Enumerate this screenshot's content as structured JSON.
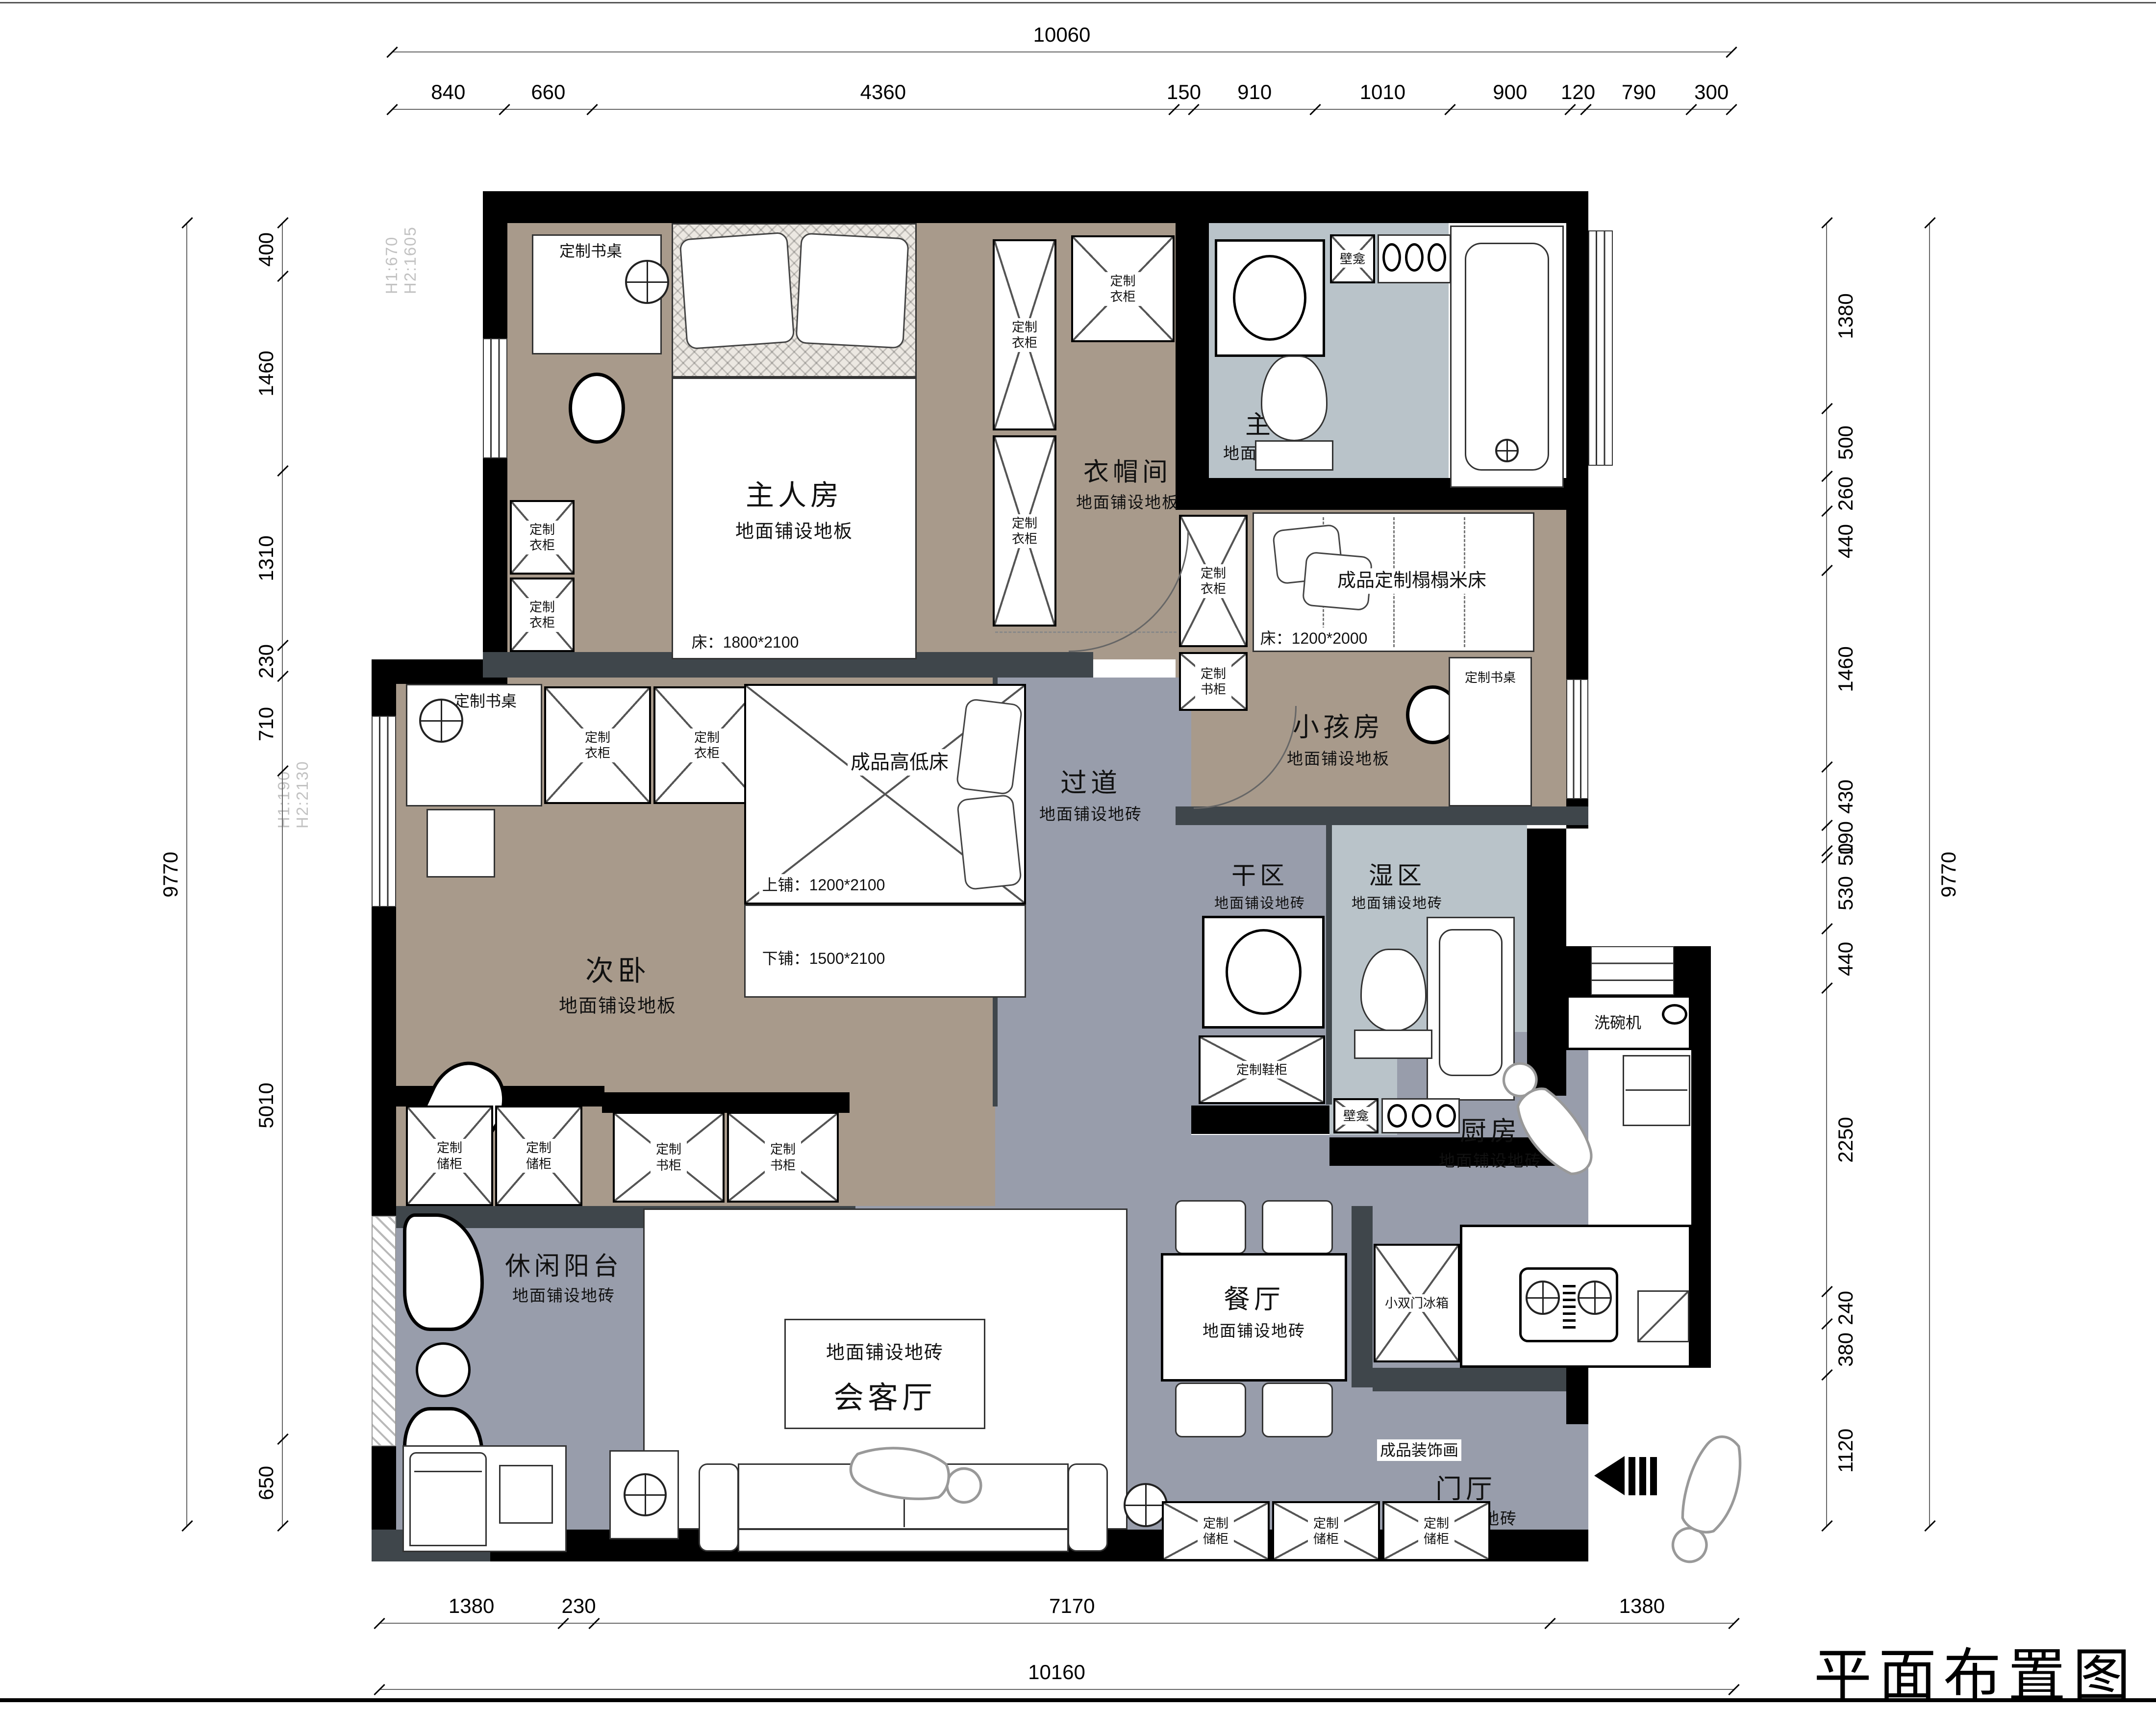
{
  "title": "平面布置图",
  "dimensions": {
    "top": {
      "overall": "10060",
      "segments": [
        "840",
        "660",
        "4360",
        "150",
        "910",
        "1010",
        "900",
        "120",
        "790",
        "300"
      ]
    },
    "bottom": {
      "overall": "10160",
      "segments": [
        "1380",
        "230",
        "7170",
        "1380"
      ]
    },
    "left": {
      "overall": "9770",
      "segments": [
        "400",
        "1460",
        "1310",
        "230",
        "710",
        "5010",
        "650"
      ]
    },
    "right": {
      "overall": "9770",
      "segments": [
        "1380",
        "500",
        "260",
        "440",
        "1460",
        "430",
        "190",
        "50",
        "530",
        "440",
        "2250",
        "240",
        "380",
        "1120"
      ]
    }
  },
  "window_notes": {
    "n1a": "H1:670",
    "n1b": "H2:1605",
    "n2a": "H1:190",
    "n2b": "H2:2130"
  },
  "rooms": {
    "master": {
      "name": "主人房",
      "floor": "地面铺设地板",
      "bed_size": "床：1800*2100"
    },
    "cloak": {
      "name": "衣帽间",
      "floor": "地面铺设地板"
    },
    "bath": {
      "name": "主卫",
      "floor": "地面铺设地砖",
      "niche": "壁龛"
    },
    "kids": {
      "name": "小孩房",
      "floor": "地面铺设地板",
      "bed": "成品定制榻榻米床",
      "bed_size": "床：1200*2000"
    },
    "second": {
      "name": "次卧",
      "floor": "地面铺设地板",
      "bed": "成品高低床",
      "upper": "上铺：1200*2100",
      "lower": "下铺：1500*2100"
    },
    "corridor": {
      "name": "过道",
      "floor": "地面铺设地砖"
    },
    "dry": {
      "name": "干区",
      "floor": "地面铺设地砖"
    },
    "wet": {
      "name": "湿区",
      "floor": "地面铺设地砖",
      "niche": "壁龛"
    },
    "balcony": {
      "name": "休闲阳台",
      "floor": "地面铺设地砖"
    },
    "living": {
      "name": "会客厅",
      "floor": "地面铺设地砖"
    },
    "dining": {
      "name": "餐厅",
      "floor": "地面铺设地砖"
    },
    "kitchen": {
      "name": "厨房",
      "floor": "地面铺设地砖",
      "dishwasher": "洗碗机",
      "fridge": "小双门冰箱"
    },
    "entry": {
      "name": "门厅",
      "floor": "地面铺设地砖",
      "art": "成品装饰画"
    }
  },
  "furniture": {
    "desk": "定制书桌",
    "wardrobe": "定制衣柜",
    "bookcase": "定制书柜",
    "storage": "定制储柜",
    "shoe": "定制鞋柜"
  },
  "colors": {
    "wall": "#000000",
    "partition": "#3f464b",
    "floor_wood": "#a89a8b",
    "floor_tile": "#989dab",
    "floor_bath": "#b9c3c9"
  }
}
